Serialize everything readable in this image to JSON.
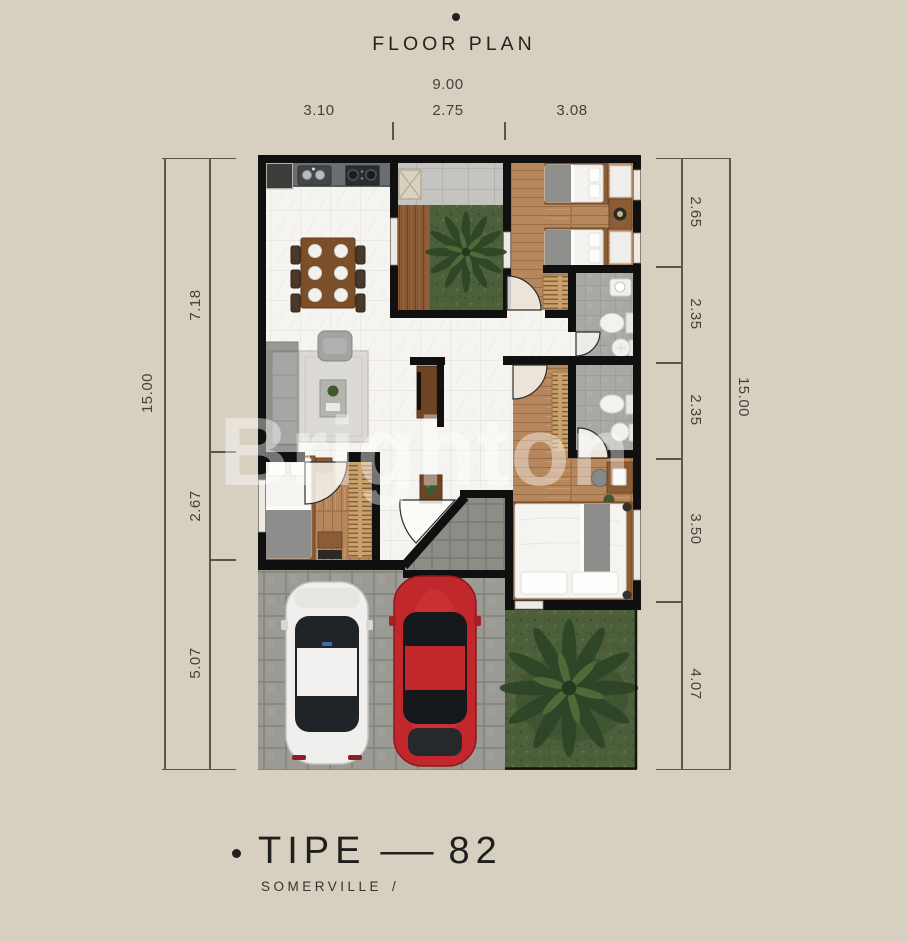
{
  "header": {
    "title": "FLOOR PLAN"
  },
  "dims": {
    "top_total": "9.00",
    "top_segments": [
      "3.10",
      "2.75",
      "3.08"
    ],
    "left_total": "15.00",
    "left_segments": [
      "7.18",
      "2.67",
      "5.07"
    ],
    "right_total": "15.00",
    "right_segments": [
      "2.65",
      "2.35",
      "2.35",
      "3.50",
      "4.07"
    ]
  },
  "watermark": {
    "text": "Brighton"
  },
  "footer": {
    "type_label": "TIPE",
    "dash": "—",
    "type_value": "82",
    "series": "SOMERVILLE",
    "slash": "/"
  },
  "colors": {
    "background": "#d7d0c1",
    "wall": "#101010",
    "marble_floor": "#f5f4f0",
    "wood_floor": "#b6875c",
    "deck_wood": "#8a5a34",
    "bath_tile": "#a9a8a4",
    "grass": "#4c5f3a",
    "paving": "#9b9a94",
    "car_white": "#f0efed",
    "car_red": "#c1272b",
    "dimension_text": "#45423c"
  }
}
